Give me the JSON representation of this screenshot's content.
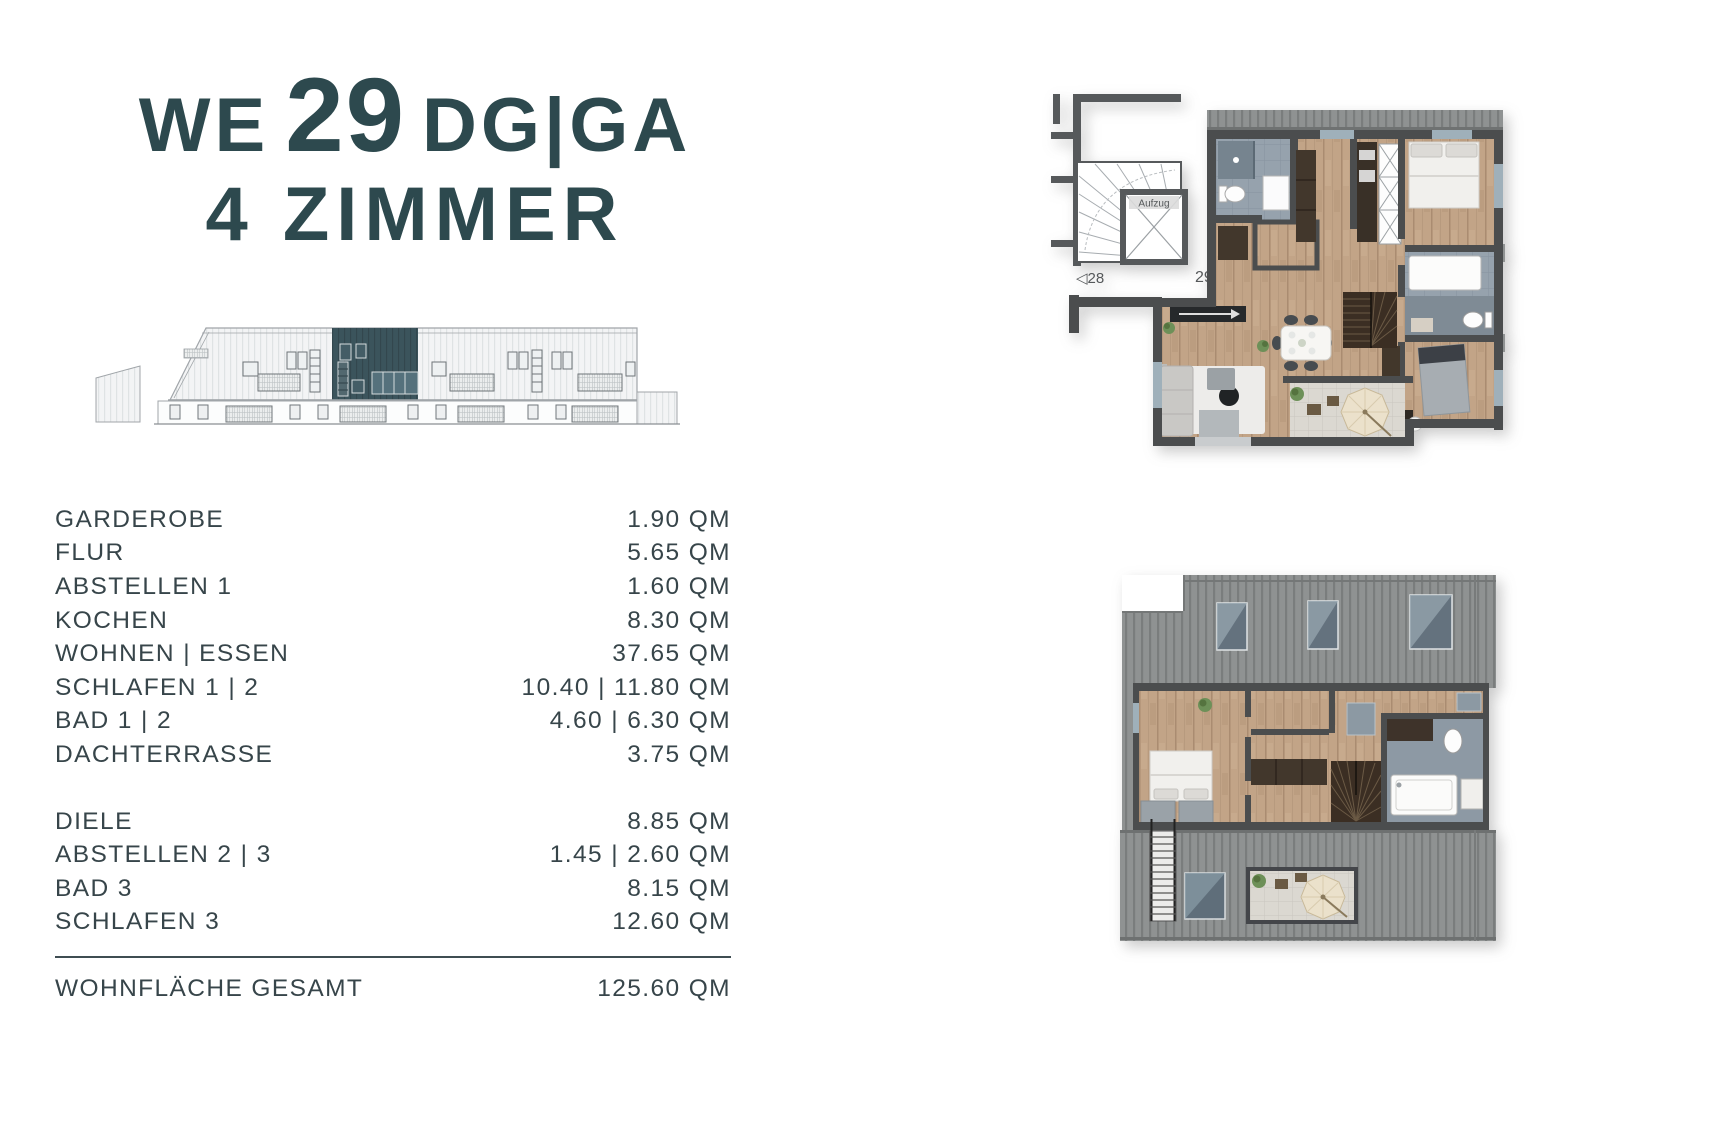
{
  "colors": {
    "accent": "#2d494e",
    "highlight_unit": "#3b545c",
    "wall": "#4b4d4e",
    "wood_floor": "#c2a487",
    "roof": "#8f9292",
    "bath_tile": "#96a2ad"
  },
  "header": {
    "line1_prefix": "WE",
    "unit_number": "29",
    "line1_suffix": "DG|GA",
    "subtitle": "4 ZIMMER"
  },
  "room_table": {
    "groups": [
      {
        "rows": [
          {
            "label": "GARDEROBE",
            "value": "1.90 QM"
          },
          {
            "label": "FLUR",
            "value": "5.65 QM"
          },
          {
            "label": "ABSTELLEN 1",
            "value": "1.60 QM"
          },
          {
            "label": "KOCHEN",
            "value": "8.30 QM"
          },
          {
            "label": "WOHNEN | ESSEN",
            "value": "37.65 QM"
          },
          {
            "label": "SCHLAFEN 1 | 2",
            "value": "10.40 | 11.80 QM"
          },
          {
            "label": "BAD 1 | 2",
            "value": "4.60 | 6.30 QM"
          },
          {
            "label": "DACHTERRASSE",
            "value": "3.75 QM"
          }
        ]
      },
      {
        "rows": [
          {
            "label": "DIELE",
            "value": "8.85 QM"
          },
          {
            "label": "ABSTELLEN 2 | 3",
            "value": "1.45 | 2.60 QM"
          },
          {
            "label": "BAD 3",
            "value": "8.15 QM"
          },
          {
            "label": "SCHLAFEN 3",
            "value": "12.60 QM"
          }
        ]
      }
    ],
    "total": {
      "label": "WOHNFLÄCHE GESAMT",
      "value": "125.60 QM"
    }
  },
  "floorplans": {
    "upper": {
      "aufzug_label": "Aufzug",
      "neighbor_left_label": "◁28",
      "unit_label": "29 ▷"
    }
  }
}
